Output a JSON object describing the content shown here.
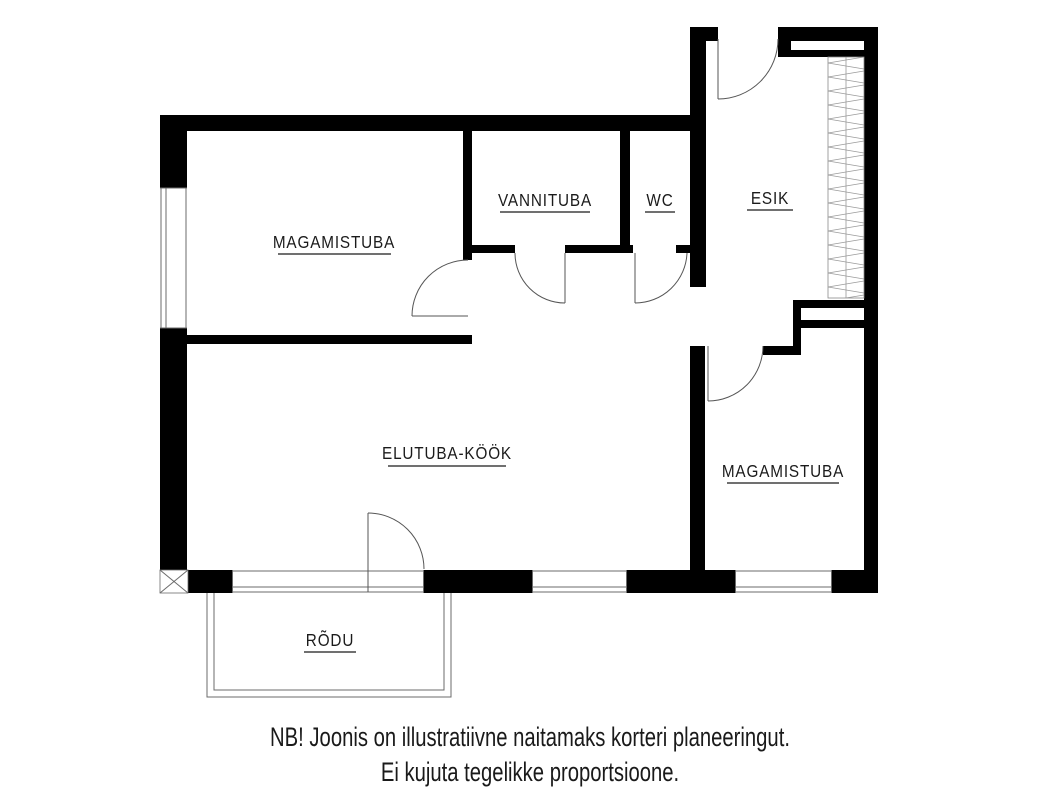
{
  "plan": {
    "title": "Apartment floor plan",
    "rooms": [
      {
        "id": "bedroom-1",
        "label": "MAGAMISTUBA"
      },
      {
        "id": "bathroom",
        "label": "VANNITUBA"
      },
      {
        "id": "wc",
        "label": "WC"
      },
      {
        "id": "hallway",
        "label": "ESIK"
      },
      {
        "id": "living-kitchen",
        "label": "ELUTUBA-KÖÖK"
      },
      {
        "id": "bedroom-2",
        "label": "MAGAMISTUBA"
      },
      {
        "id": "balcony",
        "label": "RÕDU"
      }
    ],
    "note": {
      "line1": "NB! Joonis on illustratiivne naitamaks korteri planeeringut.",
      "line2": "Ei kujuta tegelikke proportsioone."
    },
    "colors": {
      "wall": "#000000",
      "background": "#ffffff",
      "thin_line": "#6b6b6b",
      "text": "#1b1b1b"
    }
  }
}
